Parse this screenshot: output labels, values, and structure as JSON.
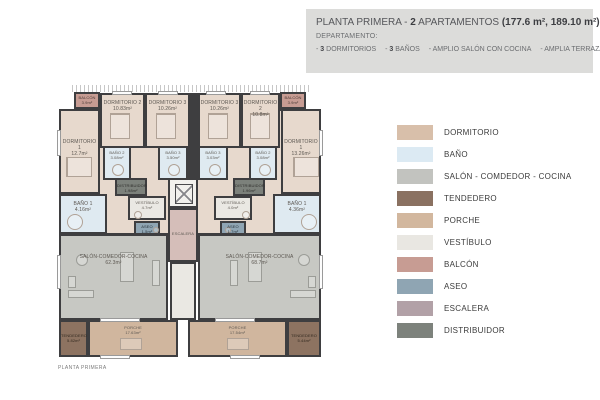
{
  "header": {
    "title_normal1": "PLANTA PRIMERA - ",
    "title_bold1": "2",
    "title_normal2": " APARTAMENTOS ",
    "title_bold2": "(177.6 m², 189.10 m²)",
    "subtitle": "DEPARTAMENTO:",
    "feat1_dash": "- ",
    "feat1_bold": "3",
    "feat1_text": " DORMITORIOS",
    "feat2_dash": "- ",
    "feat2_bold": "3",
    "feat2_text": " BAÑOS",
    "feat3_text": "- AMPLIO SALÓN CON COCINA",
    "feat4_text": "- AMPLIA TERRAZA"
  },
  "legend": {
    "items": [
      {
        "label": "DORMITORIO",
        "color": "#d8bfaa"
      },
      {
        "label": "BAÑO",
        "color": "#dceaf3"
      },
      {
        "label": "SALÓN - COMDEDOR - COCINA",
        "color": "#c2c3bf"
      },
      {
        "label": "TENDEDERO",
        "color": "#8a7161"
      },
      {
        "label": "PORCHE",
        "color": "#d2b79e"
      },
      {
        "label": "VESTÍBULO",
        "color": "#e9e7e2"
      },
      {
        "label": "BALCÓN",
        "color": "#c79c93"
      },
      {
        "label": "ASEO",
        "color": "#8fa5b3"
      },
      {
        "label": "ESCALERA",
        "color": "#b2a1a7"
      },
      {
        "label": "DISTRIBUIDOR",
        "color": "#7d827c"
      }
    ]
  },
  "plan": {
    "caption": "PLANTA PRIMERA",
    "rooms": {
      "balcon_left": {
        "name": "BALCÓN",
        "area": "3.9m²"
      },
      "balcon_right": {
        "name": "BALCÓN",
        "area": "3.9m²"
      },
      "dorm1_left": {
        "name": "DORMITORIO 1",
        "area": "12.7m²"
      },
      "dorm2_left": {
        "name": "DORMITORIO 2",
        "area": "10.83m²"
      },
      "dorm3_left": {
        "name": "DORMITORIO 3",
        "area": "10.26m²"
      },
      "dorm3_right": {
        "name": "DORMITORIO 3",
        "area": "10.26m²"
      },
      "dorm2_right": {
        "name": "DORMITORIO 2",
        "area": "10.8m²"
      },
      "dorm1_right": {
        "name": "DORMITORIO 1",
        "area": "13.26m²"
      },
      "bano2_left": {
        "name": "BAÑO 2",
        "area": "3.08m²"
      },
      "bano3_left": {
        "name": "BAÑO 3",
        "area": "3.50m²"
      },
      "bano3_right": {
        "name": "BAÑO 3",
        "area": "3.03m²"
      },
      "bano2_right": {
        "name": "BAÑO 2",
        "area": "3.08m²"
      },
      "distribuidor_left": {
        "name": "DISTRIBUIDOR",
        "area": "1.98m²"
      },
      "distribuidor_right": {
        "name": "DISTRIBUIDOR",
        "area": "1.96m²"
      },
      "bano1_left": {
        "name": "BAÑO 1",
        "area": "4.16m²"
      },
      "bano1_right": {
        "name": "BAÑO 1",
        "area": "4.36m²"
      },
      "vestibulo_left": {
        "name": "VESTÍBULO",
        "area": "4.7m²"
      },
      "vestibulo_right": {
        "name": "VESTÍBULO",
        "area": "4.0m²"
      },
      "aseo_left": {
        "name": "ASEO",
        "area": "1.5m²"
      },
      "aseo_right": {
        "name": "ASEO",
        "area": "1.7m²"
      },
      "escalera": {
        "name": "ESCALERA",
        "area": ""
      },
      "salon_left": {
        "name": "SALÓN-COMEDOR-COCINA",
        "area": "62.3m²"
      },
      "salon_right": {
        "name": "SALÓN-COMEDOR-COCINA",
        "area": "68.7m²"
      },
      "porche_left": {
        "name": "PORCHE",
        "area": "17.63m²"
      },
      "porche_right": {
        "name": "PORCHE",
        "area": "17.54m²"
      },
      "tendedero_left": {
        "name": "TENDEDERO",
        "area": "5.82m²"
      },
      "tendedero_right": {
        "name": "TENDEDERO",
        "area": "5.44m²"
      }
    }
  }
}
